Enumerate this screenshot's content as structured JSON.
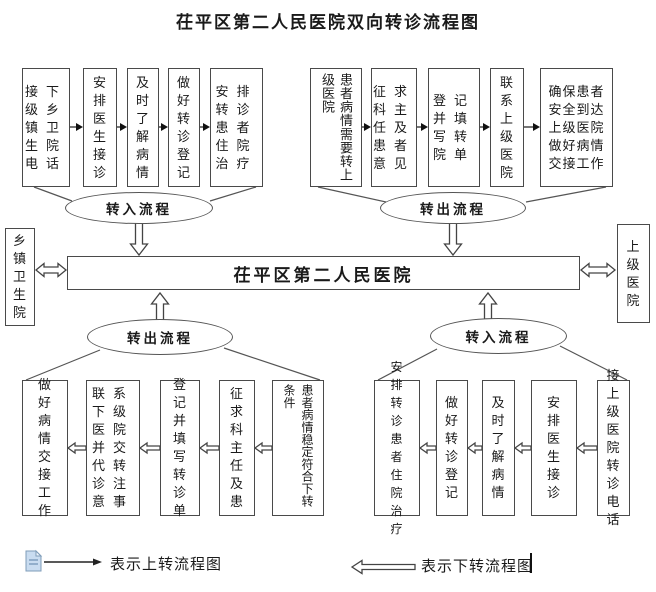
{
  "title": "茌平区第二人民医院双向转诊流程图",
  "center": {
    "hospital": "茌平区第二人民医院",
    "left_org": "乡镇卫生院",
    "right_org": "上级医院"
  },
  "flows": {
    "transfer_in_top": {
      "label": "转入流程",
      "steps": [
        "接下级乡镇卫生院电话",
        "安排医生接诊",
        "及时了解病情",
        "做好转诊登记",
        "安排转诊患者住院治疗"
      ]
    },
    "transfer_out_top": {
      "label": "转出流程",
      "steps": [
        "患者病情需要转上级医院",
        "征求科主任及患者意见",
        "登记并填写转院单",
        "联系上级医院",
        "确保患者安全到达上级医院做好病情交接工作"
      ]
    },
    "transfer_out_bottom": {
      "label": "转出流程",
      "steps": [
        "做好病情交接工作",
        "联系下级医院并交代转诊注意事",
        "登记并填写转诊单",
        "征求科主任及患",
        "患者病情稳定符合下转条件"
      ]
    },
    "transfer_in_bottom": {
      "label": "转入流程",
      "steps": [
        "安排转诊患者住院治疗",
        "做好转诊登记",
        "及时了解病情",
        "安排医生接诊",
        "接上级医院转诊电话"
      ]
    }
  },
  "legend": {
    "up_arrow_label": "表示上转流程图",
    "down_arrow_label": "表示下转流程图"
  },
  "colors": {
    "line": "#4a4a4a",
    "text": "#1a1a1a",
    "doc_icon_fill": "#c9dcf0",
    "doc_icon_stroke": "#7f9db9"
  }
}
